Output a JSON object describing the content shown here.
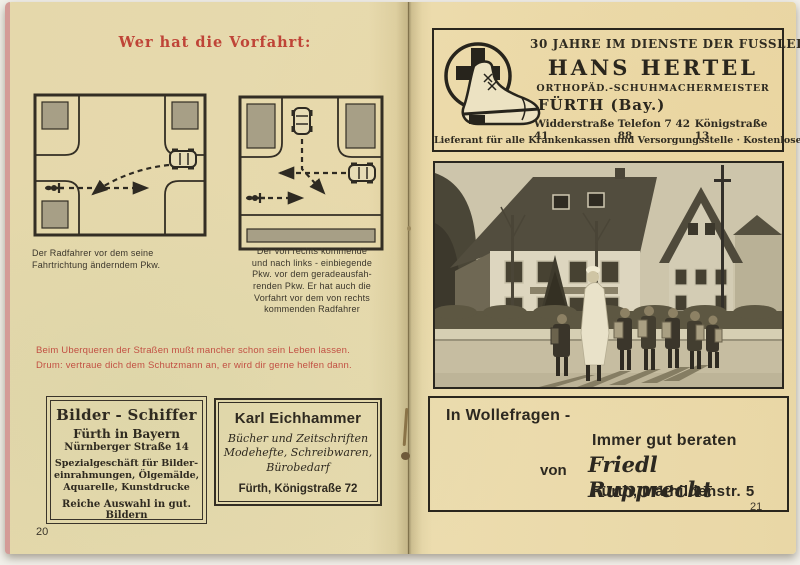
{
  "colors": {
    "accent_red": "#bf4437",
    "ink": "#332e24",
    "paper": "#e9dcae",
    "diagram_gray": "#a79f86"
  },
  "booklet": {
    "left": {
      "page_number": "20",
      "title": "Wer hat die Vorfahrt:",
      "caption1": [
        "Der Radfahrer vor dem seine",
        "Fahrtrichtung änderndem Pkw."
      ],
      "caption2": [
        "Der von rechts kommende",
        "und nach links - einbiegende",
        "Pkw. vor dem geradeausfah-",
        "renden Pkw. Er hat auch die",
        "Vorfahrt vor dem von rechts",
        "kommenden Radfahrer"
      ],
      "verse": [
        "Beim Uberqueren der Straßen mußt mancher schon sein Leben lassen.",
        "Drum: vertraue dich dem Schutzmann an, er wird dir gerne helfen dann."
      ],
      "ad_schiffer": {
        "title": "Bilder - Schiffer",
        "city": "Fürth in Bayern",
        "street": "Nürnberger Straße 14",
        "desc": [
          "Spezialgeschäft für Bilder-",
          "einrahmungen, Ölgemälde,",
          "Aquarelle, Kunstdrucke"
        ],
        "footer": "Reiche Auswahl in gut. Bildern"
      },
      "ad_eichhammer": {
        "title": "Karl Eichhammer",
        "desc": [
          "Bücher und Zeitschriften",
          "Modehefte, Schreibwaren,",
          "Bürobedarf"
        ],
        "address": "Fürth, Königstraße 72"
      }
    },
    "right": {
      "page_number": "21",
      "ad_hertel": {
        "tagline": "30 JAHRE IM DIENSTE DER FUSSLEIDENDEN",
        "name": "HANS HERTEL",
        "profession": "ORTHOPÄD.-SCHUHMACHERMEISTER",
        "city": "FÜRTH (Bay.)",
        "address_left": "Widderstraße 41",
        "phone": "Telefon 7 42 88",
        "address_right": "Königstraße 13",
        "footer": "Lieferant für alle Krankenkassen und Versorgungsstelle · Kostenlose Beratung"
      },
      "ad_rupprecht": {
        "line1": "In Wollefragen -",
        "line2": "Immer gut beraten",
        "von": "von",
        "name": "Friedl Rupprecht",
        "address": "Fürth, Mathildenstr. 5"
      }
    }
  }
}
